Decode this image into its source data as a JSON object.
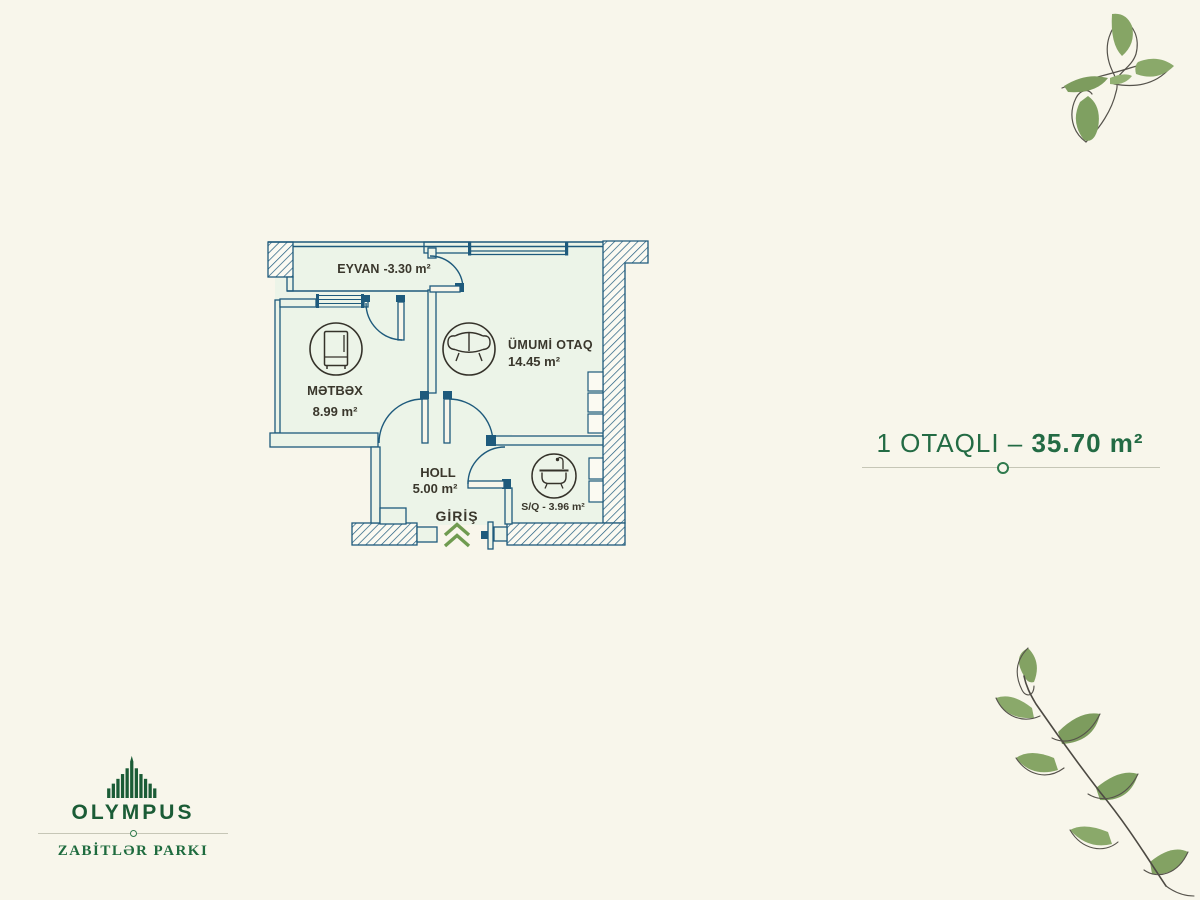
{
  "unit_banner": {
    "type_label": "1 OTAQLI –",
    "area_value": "35.70 m²",
    "text_color": "#236b44"
  },
  "plan": {
    "rooms": {
      "eyvan": {
        "name": "EYVAN",
        "area": "-3.30 m²"
      },
      "metbex": {
        "name": "MƏTBƏX",
        "area": "8.99 m²"
      },
      "umumi_otaq": {
        "name": "ÜMUMİ OTAQ",
        "area": "14.45 m²"
      },
      "holl": {
        "name": "HOLL",
        "area": "5.00 m²"
      },
      "sq": {
        "label": "S/Q - 3.96 m²"
      }
    },
    "entrance_label": "GİRİŞ",
    "icons": [
      "fridge-icon",
      "sofa-icon",
      "bathtub-icon"
    ],
    "colors": {
      "wall": "#1e5a7c",
      "room_fill": "#ecf4e8",
      "label_text": "#3a372c",
      "entrance_red": "#e2231a",
      "chevron_green": "#6f9b50"
    }
  },
  "logo": {
    "brand": "OLYMPUS",
    "park": "ZABİTLƏR PARKI",
    "green": "#1b5c36"
  },
  "page": {
    "background": "#f8f6eb"
  }
}
